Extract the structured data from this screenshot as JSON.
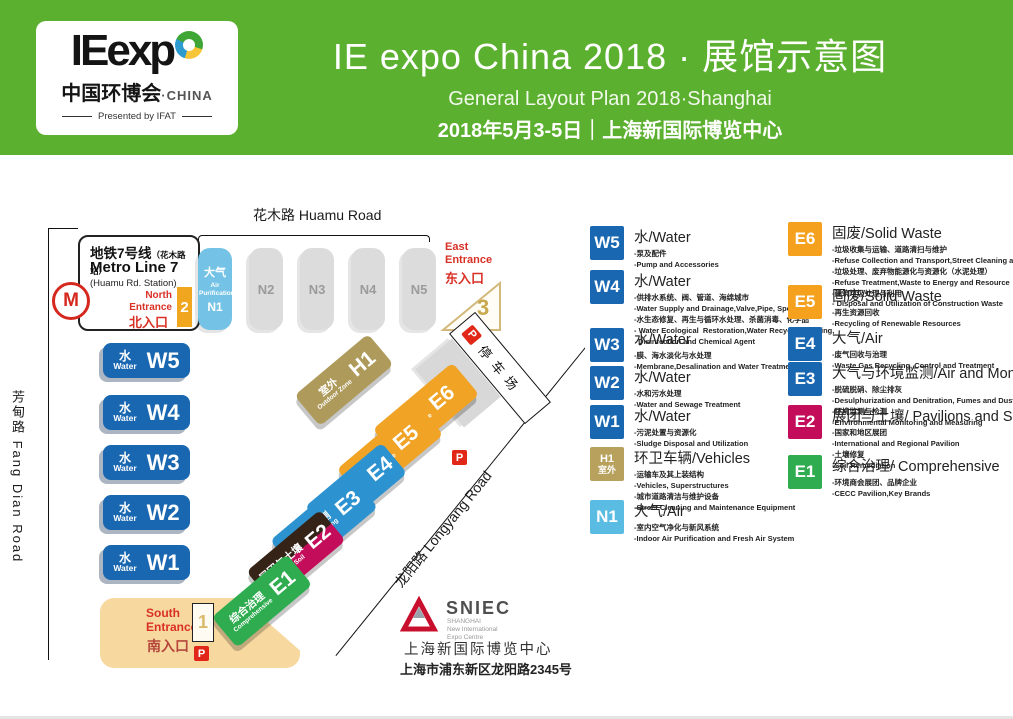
{
  "header": {
    "logo": {
      "wordmark": "IEexp",
      "cn": "中国环博会",
      "china": "·CHINA",
      "presented": "Presented by IFAT"
    },
    "title": "IE expo China 2018 · 展馆示意图",
    "subtitle": "General Layout Plan 2018·Shanghai",
    "date_line": "2018年5月3-5日｜上海新国际博览中心"
  },
  "colors": {
    "header_green": "#5CB02F",
    "water_blue": "#1A67B1",
    "air_cyan": "#2D93D0",
    "n1_lightblue": "#74C3E6",
    "solid_waste_orange": "#F0A325",
    "outdoor_tan": "#AE9B5C",
    "pavilion_crimson": "#C30D5B",
    "comprehensive_green": "#2FAC4F",
    "hall_gray": "#DCDCDC",
    "entrance_sand": "#F7D9A0",
    "alert_red": "#E02718"
  },
  "roads": {
    "huamu": "花木路 Huamu Road",
    "fangdian": "芳甸路 Fang Dian Road",
    "longyang": "龙阳路 Longyang Road"
  },
  "metro": {
    "line_zh": "地铁7号线",
    "station_zh": "（花木路站）",
    "line_en": "Metro Line 7",
    "station_en": "(Huamu Rd. Station)",
    "logo_glyph": "M"
  },
  "entrances": {
    "north": {
      "en": "North Entrance",
      "zh": "北入口",
      "num": "2"
    },
    "east": {
      "en": "East Entrance",
      "zh": "东入口",
      "num": "3"
    },
    "south": {
      "en": "South Entrance",
      "zh": "南入口",
      "num": "1"
    }
  },
  "parking": {
    "p": "P",
    "label": "停车场"
  },
  "map": {
    "halls": {
      "w5": {
        "zh": "水",
        "en": "Water",
        "id": "W5"
      },
      "w4": {
        "zh": "水",
        "en": "Water",
        "id": "W4"
      },
      "w3": {
        "zh": "水",
        "en": "Water",
        "id": "W3"
      },
      "w2": {
        "zh": "水",
        "en": "Water",
        "id": "W2"
      },
      "w1": {
        "zh": "水",
        "en": "Water",
        "id": "W1"
      },
      "n1": {
        "zh": "大气",
        "en": "Air Purification",
        "id": "N1"
      },
      "n2": {
        "id": "N2"
      },
      "n3": {
        "id": "N3"
      },
      "n4": {
        "id": "N4"
      },
      "n5": {
        "id": "N5"
      },
      "h1": {
        "zh": "室外",
        "en": "Outdoor Zone",
        "id": "H1"
      },
      "e7": {
        "id": "E7"
      },
      "e6": {
        "zh": "固废",
        "en": "Solid Waste",
        "id": "E6"
      },
      "e5": {
        "zh": "固废",
        "en": "Solid Waste",
        "id": "E5"
      },
      "e4": {
        "zh": "大气",
        "en": "Air Pollution Control",
        "id": "E4"
      },
      "e3": {
        "zh": "大气与监测",
        "en": "Air and Monitoring",
        "id": "E3"
      },
      "e2": {
        "zh": "展团与土壤",
        "en": "Pavilions, Soil",
        "id": "E2"
      },
      "e1": {
        "zh": "综合治理",
        "en": "Comprehensive",
        "id": "E1"
      }
    }
  },
  "sniec": {
    "name": "SNIEC",
    "sub1": "SHANGHAI",
    "sub2": "New International",
    "sub3": "Expo Centre",
    "cn": "上海新国际博览中心",
    "address": "上海市浦东新区龙阳路2345号"
  },
  "legend": {
    "left": [
      {
        "badge": "W5",
        "title": "水/Water",
        "lines": [
          "-泵及配件",
          "-Pump and Accessories"
        ]
      },
      {
        "badge": "W4",
        "title": "水/Water",
        "lines": [
          "-供排水系统、阀、管道、海绵城市",
          "-Water Supply and Drainage,Valve,Pipe, Sponge City",
          "-水生态修复、再生与循环水处理、杀菌消毒、化学品",
          "- Water Ecological  Restoration,Water Recycling,Dosing,",
          "  Disinfection and Chemical Agent"
        ]
      },
      {
        "badge": "W3",
        "title": "水/Water",
        "lines": [
          "-膜、海水淡化与水处理",
          "-Membrane,Desalination and Water Treatment"
        ]
      },
      {
        "badge": "W2",
        "title": "水/Water",
        "lines": [
          "-水和污水处理",
          "-Water and Sewage Treatment"
        ]
      },
      {
        "badge": "W1",
        "title": "水/Water",
        "lines": [
          "-污泥处置与资源化",
          "-Sludge Disposal and Utilization"
        ]
      },
      {
        "badge": "H1",
        "badge2": "室外",
        "title": "环卫车辆/Vehicles",
        "lines": [
          "-运输车及其上装结构",
          "-Vehicles, Superstructures",
          "-城市道路清洁与维护设备",
          "-Street Cleaning and Maintenance Equipment"
        ]
      },
      {
        "badge": "N1",
        "title": "大气/Air",
        "lines": [
          "-室内空气净化与新风系统",
          "-Indoor Air Purification and Fresh Air System"
        ]
      }
    ],
    "right": [
      {
        "badge": "E6",
        "title": "固废/Solid Waste",
        "lines": [
          "-垃圾收集与运输、道路清扫与维护",
          "-Refuse Collection and Transport,Street Cleaning and Maintenance",
          "-垃圾处理、废弃物能源化与资源化（水泥处理）",
          "-Refuse Treatment,Waste to Energy and Resource",
          "-建筑垃圾处理与利用",
          "- Disposal and Utilization of Construction Waste"
        ]
      },
      {
        "badge": "E5",
        "title": "固废/Solid Waste",
        "lines": [
          "-再生资源回收",
          "-Recycling of Renewable Resources"
        ]
      },
      {
        "badge": "E4",
        "title": "大气/Air",
        "lines": [
          "-废气回收与治理",
          "-Waste Gas Recycling, Control and Treatment"
        ]
      },
      {
        "badge": "E3",
        "title": "大气与环境监测/Air and Monitoring",
        "lines": [
          "-脱硫脱硝、除尘排灰",
          "-Desulphurization and Denitration, Fumes and Dust Removal",
          "-环境监测与检测",
          "-Environmental Monitoring and Measuring"
        ]
      },
      {
        "badge": "E2",
        "title": "展团与土壤/ Pavilions and Soil",
        "lines": [
          "-国家和地区展团",
          "-International and Regional Pavilion",
          "-土壤修复",
          "-Soil Remediation"
        ]
      },
      {
        "badge": "E1",
        "title": "综合治理/ Comprehensive",
        "lines": [
          "-环境商会展团、品牌企业",
          "-CECC Pavilion,Key Brands"
        ]
      }
    ]
  }
}
